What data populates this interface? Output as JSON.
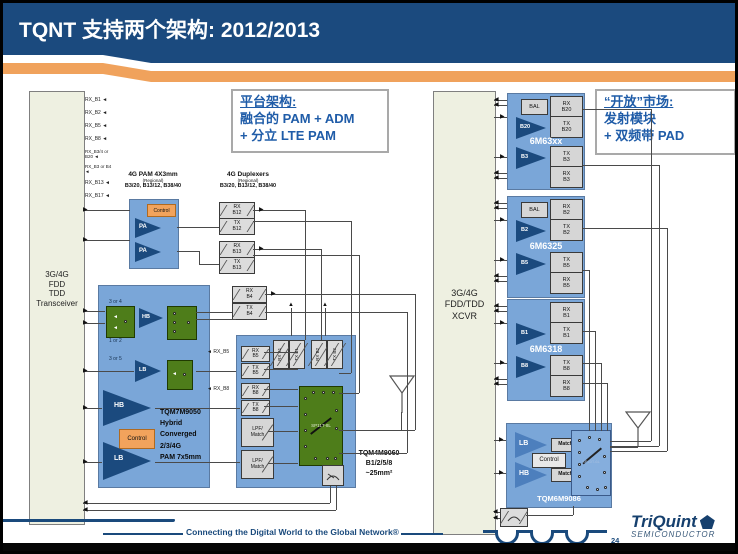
{
  "header": {
    "title": "TQNT 支持两个架构: 2012/2013"
  },
  "callouts": {
    "left": {
      "heading": "平台架构: ",
      "line1": "融合的 PAM + ADM",
      "line2": "+ 分立 LTE PAM"
    },
    "right": {
      "heading": "“开放”市场: ",
      "line1": "发射模块",
      "line2": "+ 双频带 PAD"
    }
  },
  "left": {
    "transceiver": {
      "l0": "3G/4G",
      "l1": "FDD",
      "l2": "TDD",
      "l3": "Transceiver"
    },
    "rx_ports": [
      "RX_B1",
      "RX_B2",
      "RX_B5",
      "RX_B8",
      "RX_B3/4 or B20",
      "RX_B3 or B4",
      "RX_B13",
      "RX_B17"
    ],
    "pam": {
      "h1": "4G PAM 4X3mm",
      "h2": "(Regional)",
      "h3": "B3/20, B13/12, B38/40",
      "control": "Control",
      "pa": "PA"
    },
    "dup": {
      "h1": "4G Duplexers",
      "h2": "(Regional)",
      "h3": "B3/20, B13/12, B38/40",
      "filters": [
        {
          "l1": "RX",
          "l2": "B12"
        },
        {
          "l1": "TX",
          "l2": "B12"
        },
        {
          "l1": "RX",
          "l2": "B13"
        },
        {
          "l1": "TX",
          "l2": "B13"
        }
      ]
    },
    "tqm7": {
      "ann_top": "3 or 4",
      "ann_bot": "1 or 2",
      "ann_lb": "3 or 5",
      "hb_s": "HB",
      "lb_s": "LB",
      "hb_b": "HB",
      "lb_b": "LB",
      "control": "Control",
      "name": [
        "TQM7M9050",
        "Hybrid",
        "Converged",
        "2/3/4G",
        "PAM 7x5mm"
      ]
    },
    "b4_filters": [
      {
        "l1": "RX",
        "l2": "B4"
      },
      {
        "l1": "TX",
        "l2": "B4"
      }
    ],
    "tqm4": {
      "top_filters": [
        "RX B1",
        "TX B1",
        "RX B2",
        "TX B2"
      ],
      "left_filters": [
        {
          "l1": "RX",
          "l2": "B5"
        },
        {
          "l1": "TX",
          "l2": "B5"
        },
        {
          "l1": "RX",
          "l2": "B8"
        },
        {
          "l1": "TX",
          "l2": "B8"
        }
      ],
      "lpf": {
        "l1": "LPF/",
        "l2": "Match"
      },
      "switch": "SP11T-8L",
      "name": "TQM4M9060",
      "name2": "B1/2/5/8",
      "name3": "~25mm²"
    },
    "ext_rx": [
      "RX_B5",
      "RX_B8"
    ]
  },
  "right": {
    "xcvr": {
      "l0": "3G/4G",
      "l1": "FDD/TDD",
      "l2": "XCVR"
    },
    "modules": [
      {
        "title": "6M63xx",
        "bal": "BAL",
        "amp1": "B20",
        "amp2": "B3",
        "ports": [
          {
            "l1": "RX",
            "l2": "B20"
          },
          {
            "l1": "TX",
            "l2": "B20"
          },
          {
            "l1": "TX",
            "l2": "B3"
          },
          {
            "l1": "RX",
            "l2": "B3"
          }
        ]
      },
      {
        "title": "6M6325",
        "bal": "BAL",
        "amp1": "B2",
        "amp2": "B5",
        "ports": [
          {
            "l1": "RX",
            "l2": "B2"
          },
          {
            "l1": "TX",
            "l2": "B2"
          },
          {
            "l1": "TX",
            "l2": "B5"
          },
          {
            "l1": "RX",
            "l2": "B5"
          }
        ]
      },
      {
        "title": "6M6318",
        "amp1": "B1",
        "amp2": "B8",
        "ports": [
          {
            "l1": "RX",
            "l2": "B1"
          },
          {
            "l1": "TX",
            "l2": "B1"
          },
          {
            "l1": "TX",
            "l2": "B8"
          },
          {
            "l1": "RX",
            "l2": "B8"
          }
        ]
      }
    ],
    "tqm6": {
      "title": "TQM6M9086",
      "lb": "LB",
      "hb": "HB",
      "match": "Match",
      "control": "Control",
      "switch": "SP10T-6L"
    }
  },
  "footer": {
    "tagline": "Connecting the Digital World to the Global Network®",
    "page": "24",
    "brand": "TriQuint",
    "brand_sub": "SEMICONDUCTOR"
  }
}
